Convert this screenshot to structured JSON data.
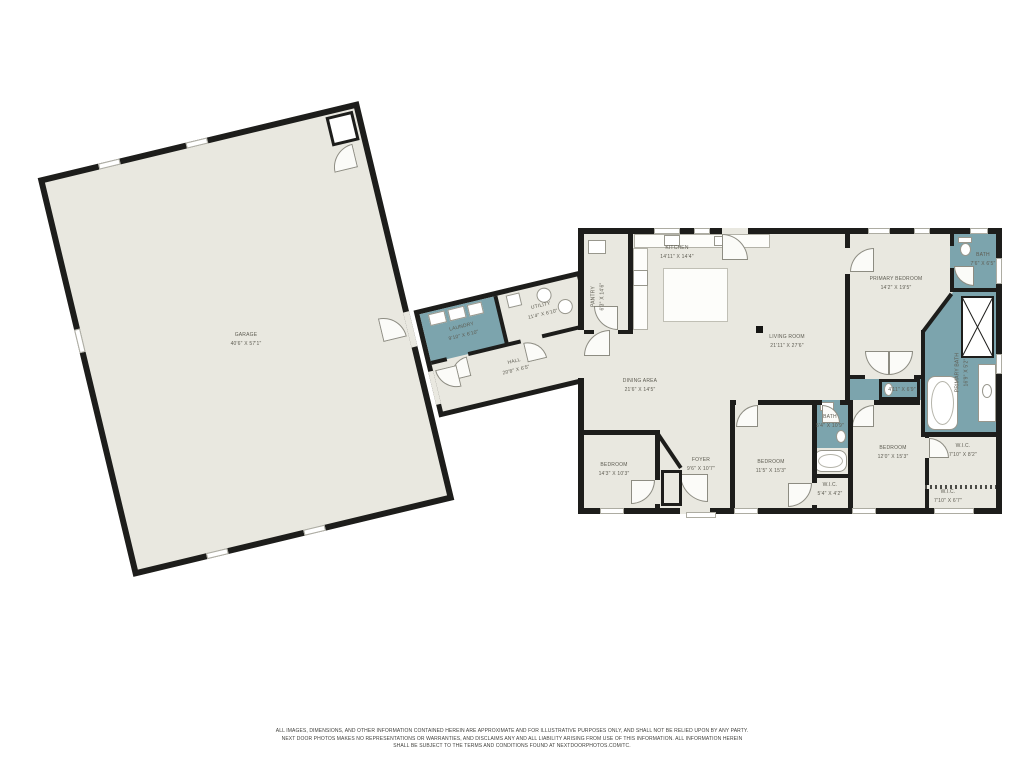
{
  "rooms": {
    "garage": {
      "name": "GARAGE",
      "dims": "40'6\" X 57'1\""
    },
    "laundry": {
      "name": "LAUNDRY",
      "dims": "9'10\" X 6'10\""
    },
    "utility": {
      "name": "UTILITY",
      "dims": "11'4\" X 6'10\""
    },
    "hall": {
      "name": "HALL",
      "dims": "20'8\" X 6'5\""
    },
    "pantry": {
      "name": "PANTRY",
      "dims": "6'3\" X 14'6\""
    },
    "kitchen": {
      "name": "KITCHEN",
      "dims": "14'11\" X 14'4\""
    },
    "living_room": {
      "name": "LIVING ROOM",
      "dims": "21'11\" X 27'6\""
    },
    "dining_area": {
      "name": "DINING AREA",
      "dims": "21'6\" X 14'5\""
    },
    "primary_bedroom": {
      "name": "PRIMARY BEDROOM",
      "dims": "14'2\" X 19'5\""
    },
    "bath_top": {
      "name": "BATH",
      "dims": "7'6\" X 6'5\""
    },
    "primary_bath": {
      "name": "PRIMARY BATH",
      "dims": "16'9\" X 5'2\""
    },
    "water_closet": {
      "name": "",
      "dims": "4'11\" X 6'9\""
    },
    "wic_primary": {
      "name": "W.I.C.",
      "dims": "7'10\" X 8'2\""
    },
    "wic_small": {
      "name": "W.I.C.",
      "dims": "7'10\" X 6'7\""
    },
    "bedroom_right": {
      "name": "BEDROOM",
      "dims": "12'0\" X 15'3\""
    },
    "bath_hall": {
      "name": "BATH",
      "dims": "5'4\" X 10'9\""
    },
    "wic_hall": {
      "name": "W.I.C.",
      "dims": "5'4\" X 4'2\""
    },
    "bedroom_middle": {
      "name": "BEDROOM",
      "dims": "11'5\" X 15'3\""
    },
    "foyer": {
      "name": "FOYER",
      "dims": "9'6\" X 10'7\""
    },
    "bedroom_left": {
      "name": "BEDROOM",
      "dims": "14'3\" X 10'3\""
    }
  },
  "disclaimer": {
    "line1": "ALL IMAGES, DIMENSIONS, AND OTHER INFORMATION CONTAINED HEREIN ARE APPROXIMATE AND FOR ILLUSTRATIVE PURPOSES ONLY, AND SHALL NOT BE RELIED UPON BY ANY PARTY.",
    "line2": "NEXT DOOR PHOTOS MAKES NO REPRESENTATIONS OR WARRANTIES, AND DISCLAIMS ANY AND ALL LIABILITY ARISING FROM USE OF THIS INFORMATION. ALL INFORMATION HEREIN",
    "line3": "SHALL BE SUBJECT TO THE TERMS AND CONDITIONS FOUND AT NEXTDOORPHOTOS.COM/TC."
  },
  "colors": {
    "floor": "#e9e8e0",
    "wet_room": "#7ca4ad",
    "wall": "#1d1d1b",
    "label": "#5e5c52"
  }
}
